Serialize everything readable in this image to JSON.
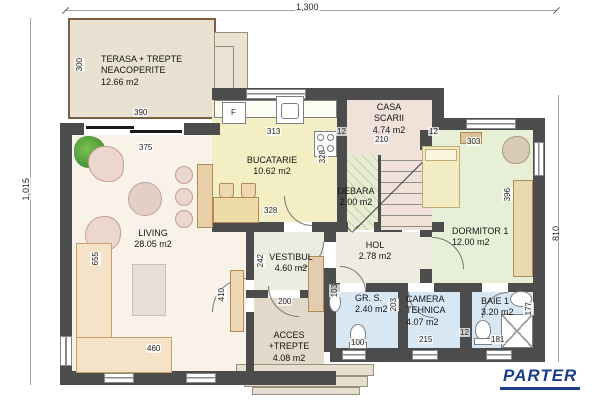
{
  "title": {
    "label": "PARTER",
    "color": "#1e3c8c"
  },
  "overall_dims": {
    "top_width": "1,300",
    "left_height": "1,015",
    "right_height": "810"
  },
  "dims_misc": {
    "wall_thickness": "12"
  },
  "fixtures": {
    "fridge_label": "F"
  },
  "rooms": {
    "terasa": {
      "line1": "TERASA + TREPTE",
      "line2": "NEACOPERITE",
      "area": "12.66 m2",
      "dim_h": "300",
      "dim_w": "390"
    },
    "living": {
      "name": "LIVING",
      "area": "28.05 m2",
      "dim_w": "375",
      "dim_h": "655",
      "dim_sofa": "460",
      "dim_right": "410"
    },
    "bucatarie": {
      "name": "BUCATARIE",
      "area": "10.62 m2",
      "dim_w": "313",
      "dim_h": "328",
      "dim_w2": "328"
    },
    "casa_scarii": {
      "line1": "CASA",
      "line2": "SCARII",
      "area": "4.74 m2",
      "dim_w": "210"
    },
    "debara": {
      "name": "DEBARA",
      "area": "2.00 m2"
    },
    "dormitor": {
      "name": "DORMITOR 1",
      "area": "12.00 m2",
      "dim_w": "303",
      "dim_h": "396"
    },
    "vestibul": {
      "name": "VESTIBUL",
      "area": "4.60 m2",
      "dim_h": "242",
      "dim_w": "200"
    },
    "hol": {
      "name": "HOL",
      "area": "2.78 m2"
    },
    "gr_s": {
      "name": "GR. S.",
      "area": "2.40 m2",
      "dim_h": "103",
      "dim_w": "100"
    },
    "camera_tehnica": {
      "line1": "CAMERA",
      "line2": "TEHNICA",
      "area": "4.07 m2",
      "dim_h": "203",
      "dim_w": "215"
    },
    "baie": {
      "name": "BAIE 1",
      "area": "3.20 m2",
      "dim_w": "181",
      "dim_h": "177"
    },
    "acces": {
      "line1": "ACCES",
      "line2": "+TREPTE",
      "area": "4.08 m2"
    }
  },
  "colors": {
    "wall": "#4c4c4c",
    "living_floor": "#f8f2e8",
    "kitchen_floor": "#f3eec3",
    "stair_floor": "#f0e2d8",
    "debara_floor": "#e7ecd3",
    "bedroom_floor": "#e8efd7",
    "hall_floor": "#eeebe1",
    "vestibule_floor": "#eaeddf",
    "wet_room_floor": "#d7e7f4",
    "access_floor": "#e2d9ca",
    "terrace_floor": "#e9e2d3",
    "terrace_border": "#7c5f41"
  }
}
